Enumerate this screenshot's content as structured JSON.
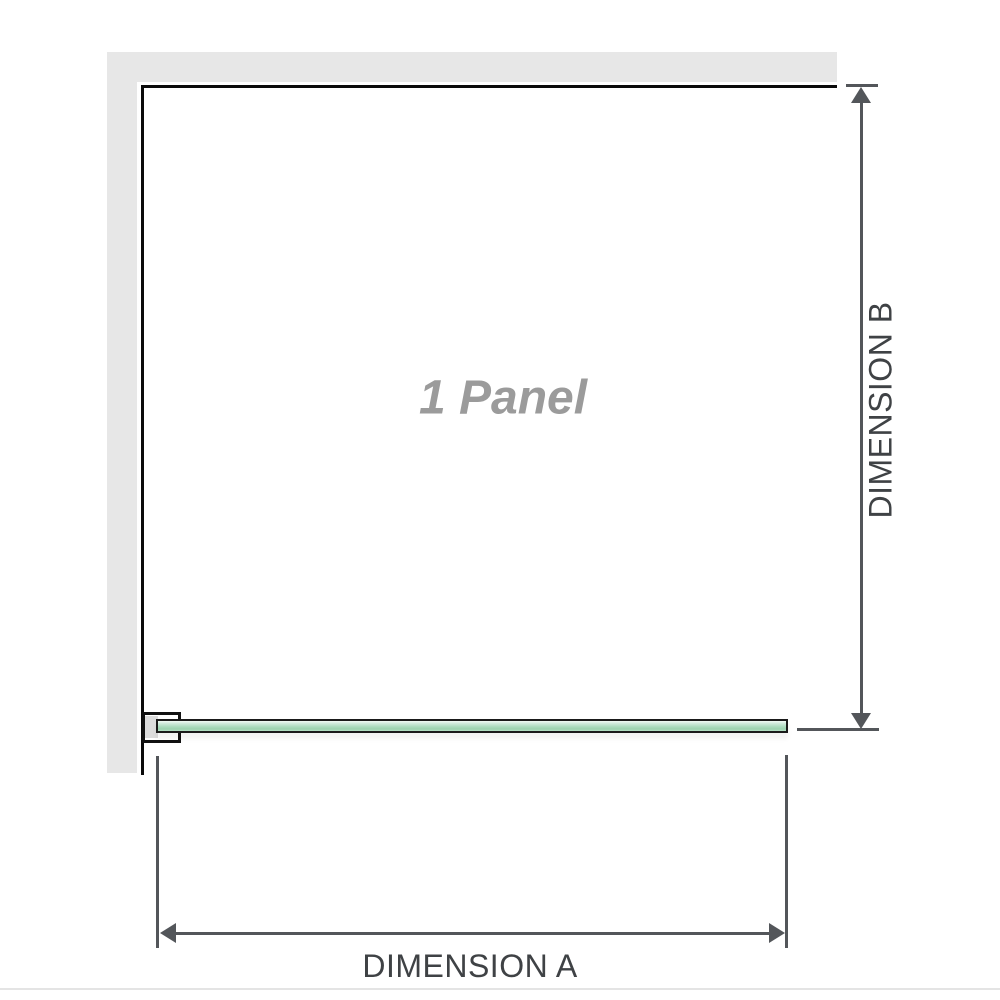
{
  "diagram": {
    "labels": {
      "panel": "1 Panel",
      "dimension_a": "DIMENSION A",
      "dimension_b": "DIMENSION B"
    },
    "colors": {
      "wall_fill": "#e7e7e7",
      "wall_edge": "#0a0a0a",
      "dimension_line": "#53565a",
      "dimension_text": "#3f4245",
      "panel_label_text": "#9b9b9b",
      "glass_border": "#1a1a1a",
      "glass_green_light": "#cfeadb",
      "glass_green_dark": "#9bd2af",
      "bracket_border": "#111111",
      "bracket_inner_fill": "#dcdcdc",
      "baseline": "#e4e4e4"
    },
    "icons": {
      "dimension_b_ends": "up-down-arrowheads",
      "dimension_a_ends": "left-right-arrowheads"
    }
  }
}
